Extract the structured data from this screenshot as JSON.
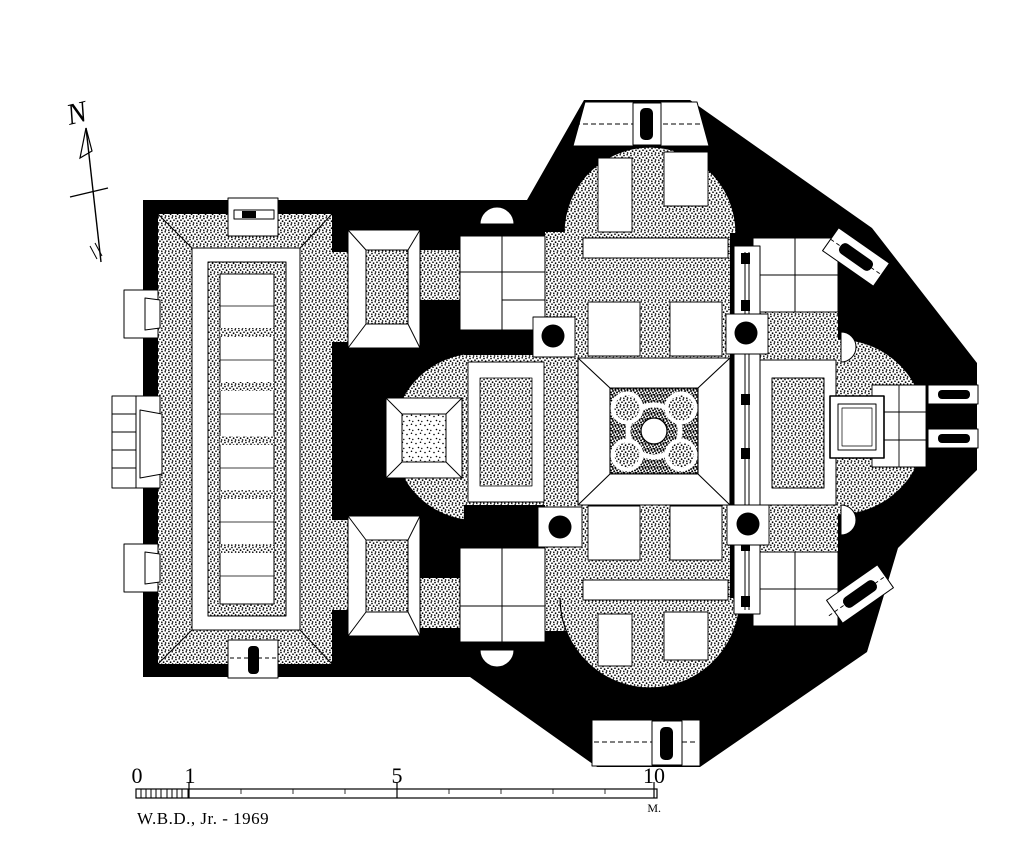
{
  "page": {
    "background": "#ffffff",
    "ink": "#000000"
  },
  "compass": {
    "label": "N",
    "icon": "north-arrow-icon"
  },
  "scale_bar": {
    "tick_labels": [
      "0",
      "1",
      "5",
      "10"
    ],
    "unit_label": "M.",
    "total_meters": 10,
    "icon": "scale-bar-icon"
  },
  "signature": {
    "credit": "W.B.D., Jr. - 1969"
  },
  "plan": {
    "subject": "church floor plan",
    "features": [
      "western hall with carpet pavement",
      "north conch",
      "south conch",
      "west conch",
      "crossing with mosaic omphalion",
      "four columns",
      "chancel screen with posts",
      "apse",
      "altar",
      "north porch door",
      "south porch door",
      "wall windows",
      "side annexes"
    ]
  }
}
